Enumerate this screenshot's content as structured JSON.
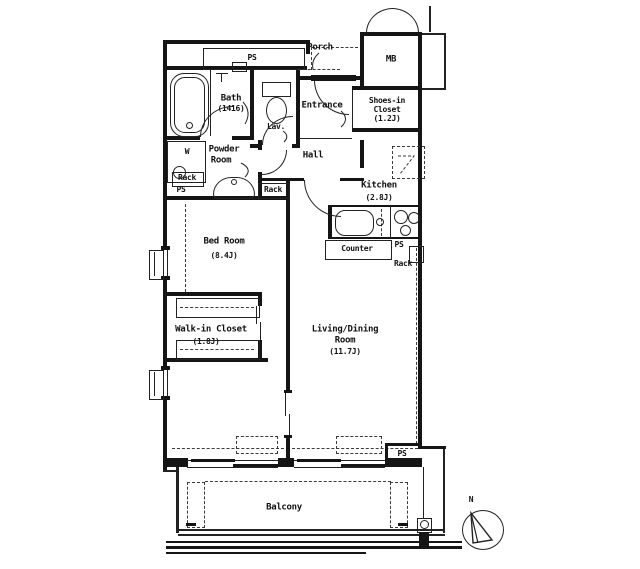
{
  "colors": {
    "ink": "#151515",
    "paper": "#ffffff"
  },
  "labels": {
    "ps": "PS",
    "porch": "Porch",
    "mb": "MB",
    "bath_name": "Bath",
    "bath_size": "(1416)",
    "lav": "Lav.",
    "entrance": "Entrance",
    "shoes1": "Shoes-in",
    "shoes2": "Closet",
    "shoes3": "(1.2J)",
    "powder1": "Powder",
    "powder2": "Room",
    "washer": "W",
    "rack": "Rack",
    "hall": "Hall",
    "kitchen_name": "Kitchen",
    "kitchen_size": "(2.8J)",
    "counter": "Counter",
    "bedroom_name": "Bed Room",
    "bedroom_size": "(8.4J)",
    "wic_name": "Walk-in Closet",
    "wic_size": "(1.8J)",
    "living1": "Living/Dining",
    "living2": "Room",
    "living3": "(11.7J)",
    "balcony": "Balcony",
    "north": "N"
  }
}
